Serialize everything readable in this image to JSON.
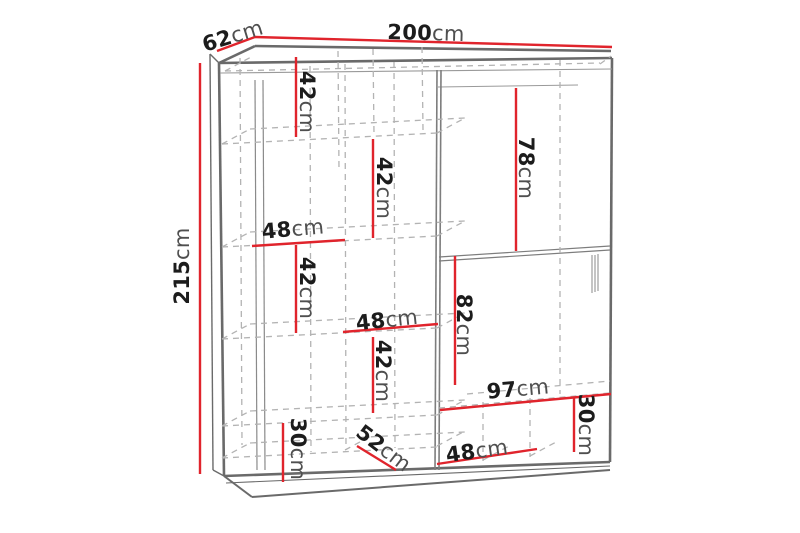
{
  "diagram": "wardrobe-dimension-drawing",
  "colors": {
    "dimension_line": "#e0242c",
    "number_text": "#1c1c1c",
    "unit_text": "#4f4f4f",
    "cabinet_line": "#6a6a6a",
    "dashed_interior_line": "#b3b3b3",
    "background": "#ffffff"
  },
  "dims": {
    "width_total": {
      "value": "200",
      "unit": "cm"
    },
    "depth_total": {
      "value": "62",
      "unit": "cm"
    },
    "height_total": {
      "value": "215",
      "unit": "cm"
    },
    "shelf_gap_a": {
      "value": "42",
      "unit": "cm"
    },
    "shelf_gap_b": {
      "value": "42",
      "unit": "cm"
    },
    "shelf_gap_c": {
      "value": "42",
      "unit": "cm"
    },
    "shelf_gap_d": {
      "value": "42",
      "unit": "cm"
    },
    "door_top_panel": {
      "value": "78",
      "unit": "cm"
    },
    "hanging_section": {
      "value": "82",
      "unit": "cm"
    },
    "shelf_width_left": {
      "value": "48",
      "unit": "cm"
    },
    "shelf_width_mid": {
      "value": "48",
      "unit": "cm"
    },
    "shelf_width_bottom": {
      "value": "48",
      "unit": "cm"
    },
    "bottom_section_w": {
      "value": "97",
      "unit": "cm"
    },
    "bottom_left_h": {
      "value": "30",
      "unit": "cm"
    },
    "bottom_right_h": {
      "value": "30",
      "unit": "cm"
    },
    "inner_depth": {
      "value": "52",
      "unit": "cm"
    }
  }
}
